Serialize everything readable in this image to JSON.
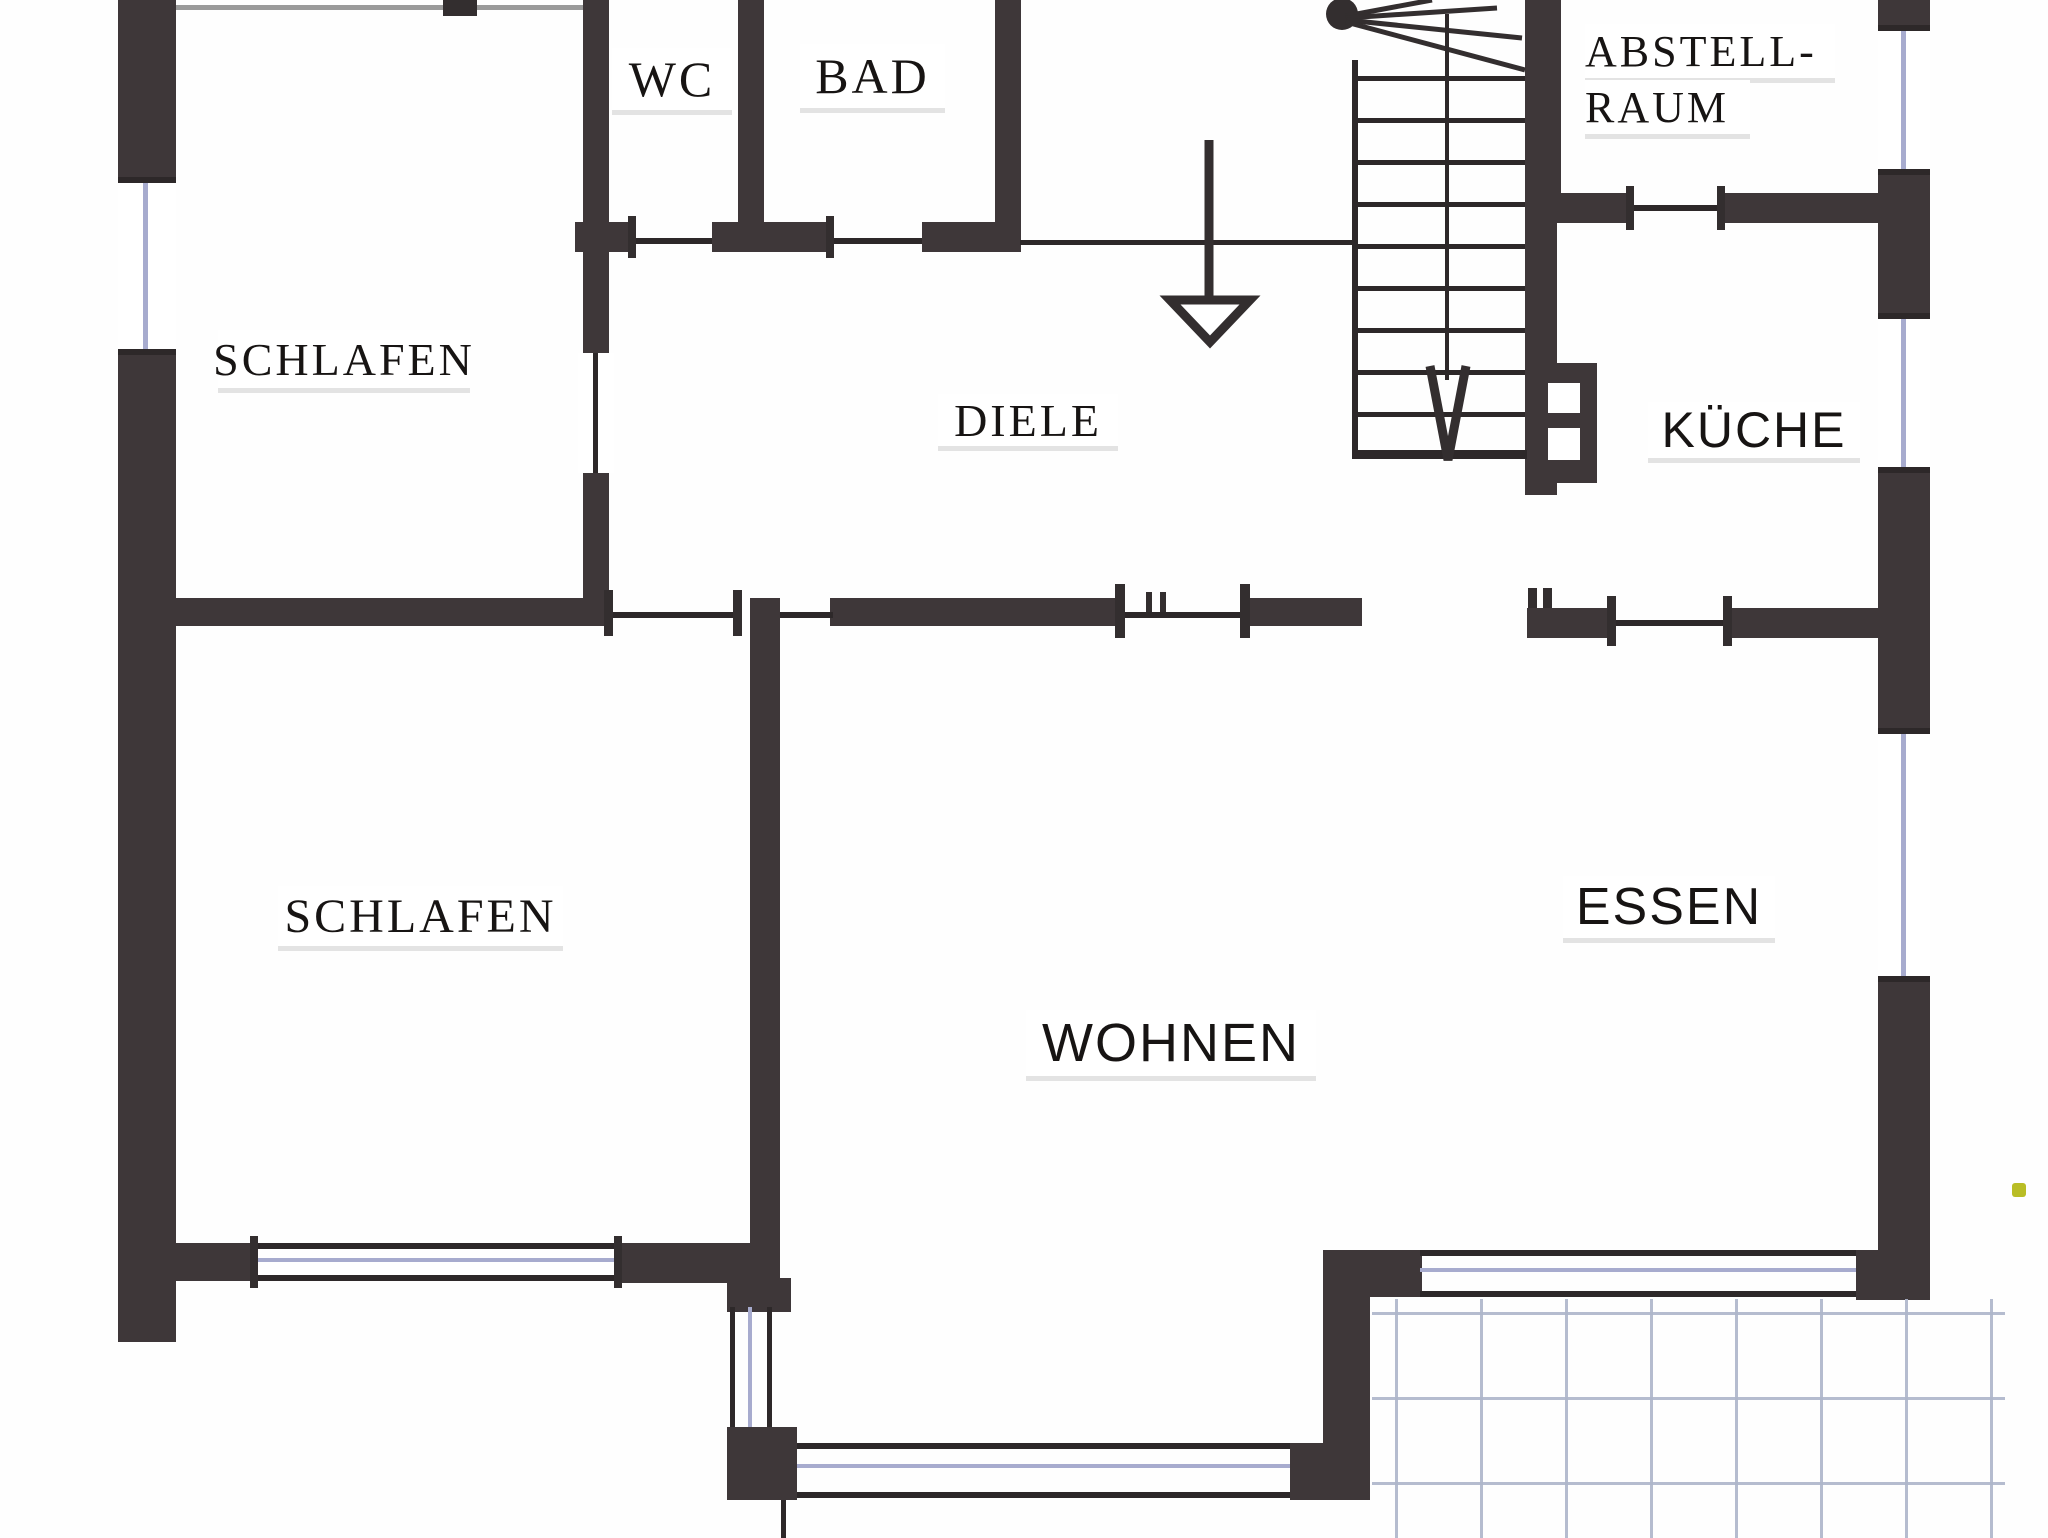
{
  "document": {
    "type": "scanned-floor-plan",
    "language": "German"
  },
  "rooms": {
    "wc": {
      "label": "WC"
    },
    "bad": {
      "label": "BAD"
    },
    "abstellraum": {
      "label_line1": "ABSTELL-",
      "label_line2": "RAUM"
    },
    "schlafen_top": {
      "label": "SCHLAFEN"
    },
    "diele": {
      "label": "DIELE"
    },
    "kueche": {
      "label": "KÜCHE"
    },
    "schlafen_bottom": {
      "label": "SCHLAFEN"
    },
    "essen": {
      "label": "ESSEN"
    },
    "wohnen": {
      "label": "WOHNEN"
    }
  },
  "symbols": {
    "entrance_arrow": "down-arrow into hallway",
    "stair_walk_arrow": "down-arrow along stair walking line",
    "staircase": "straight run with winder at top, 9 treads",
    "chimney": "black block with two white vents",
    "terrace": "light blue tile grid, bottom right",
    "windows": "double-line wall openings with light blue glazing line"
  },
  "colors": {
    "wall": "#3e3739",
    "thin_line": "#2d2829",
    "glazing_line": "#a7abce",
    "tile_grid": "#adb5ca",
    "paper": "#fefefe",
    "artifact_dot": "#b9bd25"
  }
}
